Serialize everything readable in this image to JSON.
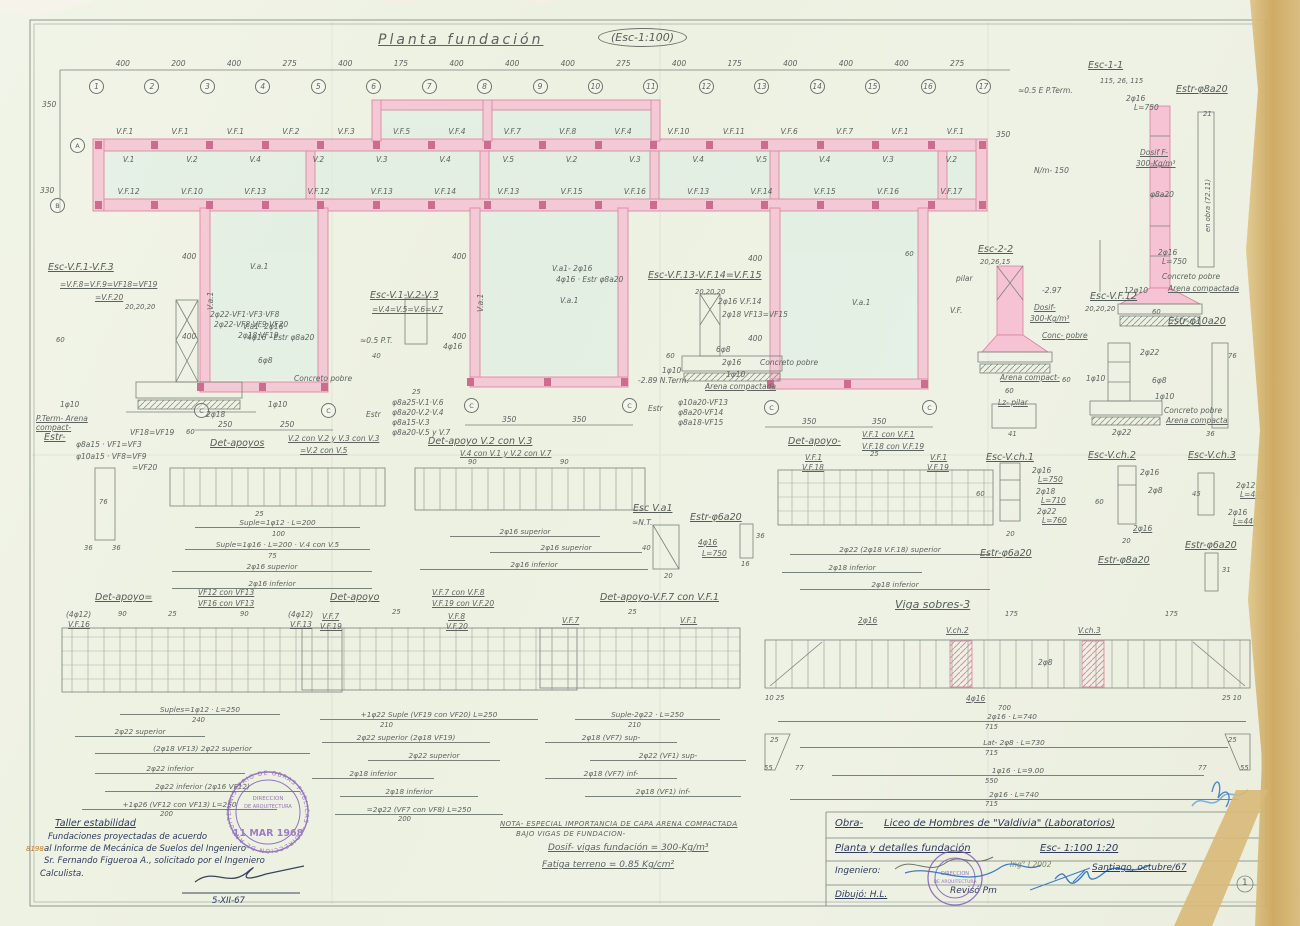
{
  "title": {
    "name": "Planta fundación",
    "scale": "(Esc-1:100)"
  },
  "plan": {
    "dims_top": [
      "400",
      "200",
      "400",
      "275",
      "400",
      "175",
      "400",
      "400",
      "400",
      "275",
      "400",
      "175",
      "400",
      "400",
      "400",
      "275"
    ],
    "bubbles": [
      "1",
      "2",
      "3",
      "4",
      "5",
      "6",
      "7",
      "8",
      "9",
      "10",
      "11",
      "12",
      "13",
      "14",
      "15",
      "16",
      "17"
    ],
    "row_a": "A",
    "row_b": "B",
    "row_c": "C",
    "dim_350": "350",
    "dim_330": "330",
    "dim_400": "400",
    "dim_60": "60",
    "top_beams": [
      "V.F.1",
      "V.F.1",
      "V.F.1",
      "V.F.2",
      "V.F.3",
      "V.F.5",
      "V.F.4",
      "V.F.7",
      "V.F.8",
      "V.F.4",
      "V.F.10",
      "V.F.11",
      "V.F.6",
      "V.F.7",
      "V.F.1",
      "V.F.1"
    ],
    "inner_beams": [
      "V.1",
      "V.2",
      "V.4",
      "V.2",
      "V.3",
      "V.4",
      "V.5",
      "V.2",
      "V.3",
      "V.4",
      "V.5",
      "V.4",
      "V.3",
      "V.2"
    ],
    "bottom_beams": [
      "V.F.12",
      "V.F.10",
      "V.F.13",
      "V.F.12",
      "V.F.13",
      "V.F.14",
      "V.F.13",
      "V.F.15",
      "V.F.16",
      "V.F.13",
      "V.F.14",
      "V.F.15",
      "V.F.16",
      "V.F.17"
    ],
    "wing1_dims": [
      "250",
      "250"
    ],
    "wing2_dims": [
      "350",
      "350"
    ],
    "wing3_dims": [
      "350",
      "350"
    ],
    "wall_label": "V.a.1",
    "wnote1": "V.a1- 2φ16",
    "wnote2": "4φ16 · Estr φ8a20"
  },
  "esc11": {
    "title": "Esc-1-1",
    "dims": "115, 26, 115",
    "estr": "Estr-φ8a20",
    "pterm": "≈0.5 E P.Term.",
    "bars_top": "2φ16",
    "bars_top_l": "L=750",
    "dosif1": "Dosif F-",
    "dosif2": "300-Kg/m³",
    "stirrup": "φ8a20",
    "bars_bot": "2φ16",
    "bars_bot_l": "L=750",
    "conc": "Concreto pobre",
    "arena": "Arena compactada",
    "b12": "12φ10",
    "w60": "60",
    "nm": "N/m- 150",
    "d350": "350",
    "bar21": "21",
    "obra": "en obra (72.11)"
  },
  "s1": {
    "t1": "Esc-V.F.1-V.F.3",
    "t2": "=V.F.8=V.F.9=VF18=VF19",
    "t3": "=V.F.20",
    "d20": "20,20,20",
    "l1": "2φ22-VF1·VF3·VF8",
    "l2": "2φ22-VF8·VF9·VF20",
    "l3": "2φ18 VF19",
    "l4": "6φ8",
    "d60": "60",
    "conc": "Concreto pobre",
    "f10a": "1φ10",
    "f10b": "1φ10",
    "f18": "2φ18",
    "arena": "P.Term- Arena compact-",
    "dbase": "60"
  },
  "s2": {
    "t1": "Esc-V.1-V.2-V.3",
    "t2": "=V.4=V.5=V.6=V.7",
    "pt": "≈0.5 P.T.",
    "d40": "40",
    "bars": "4φ16",
    "d25": "25",
    "estr": "Estr",
    "e1": "φ8a25-V.1·V.6",
    "e2": "φ8a20-V.2·V.4",
    "e3": "φ8a15-V.3",
    "e4": "φ8a20-V.5 y V.7"
  },
  "s3": {
    "t1": "Esc-V.F.13-V.F.14=V.F.15",
    "d20": "20,20,20",
    "l1": "2φ16 V.F.14",
    "l2": "2φ18 VF13=VF15",
    "l3": "6φ8",
    "d60": "60",
    "f10a": "1φ10",
    "f16": "2φ16",
    "f10b": "1φ10",
    "conc": "Concreto pobre",
    "arena": "Arena compactada",
    "nterm": "-2.89 N.Term.",
    "estr": "Estr",
    "e1": "φ10a20-VF13",
    "e2": "φ8a20-VF14",
    "e3": "φ8a18-VF15"
  },
  "s4": {
    "t1": "Esc-2-2",
    "dims": "20,26,15",
    "pilar": "pilar",
    "vf": "V.F.",
    "n297": "-2.97",
    "dosif1": "Dosif-",
    "dosif2": "300-Kg/m³",
    "conc": "Conc- pobre",
    "arena": "Arena compact-",
    "d60": "60",
    "lz": "Lz- pilar",
    "d41": "41"
  },
  "s5": {
    "t1": "Esc-V.F.12",
    "dims": "20,20,20",
    "estr": "Estr-φ10a20",
    "l1": "2φ22",
    "l2": "6φ8",
    "f10a": "1φ10",
    "f10b": "1φ10",
    "d60": "60",
    "conc": "Concreto pobre",
    "arena": "Arena compacta",
    "l3": "2φ22",
    "b76": "76",
    "b36": "36"
  },
  "estrtab": {
    "t": "Estr-",
    "l1": "VF18=VF19",
    "l2": "φ8a15 · VF1=VF3",
    "l3": "φ10a15 · VF8=VF9",
    "l4": "=VF20",
    "b76": "76",
    "b36a": "36",
    "b36b": "36"
  },
  "det1": {
    "t": "Det-apoyos",
    "b1": "V.2 con V.2 y V.3 con V.3",
    "b2": "=V.2 con V.5",
    "d25": "25",
    "s1": "Suple=1φ12 · L=200",
    "n100": "100",
    "s2": "Suple=1φ16 · L=200 · V.4 con V.5",
    "n75": "75",
    "s3": "2φ16 superior",
    "s4": "2φ16 inferior"
  },
  "det2": {
    "t": "Det-apoyo V.2 con V.3",
    "sub": "V.4 con V.1 y V.2 con V.7",
    "d90a": "90",
    "d90b": "90",
    "s1": "2φ16 superior",
    "s2": "2φ16 superior",
    "s3": "2φ16 inferior"
  },
  "det3": {
    "t": "Det-apoyo-",
    "b1": "V.F.1 con V.F.1",
    "b2": "V.F.18 con V.F.19",
    "lta": "V.F.1",
    "ltb": "V.F.18",
    "rta": "V.F.1",
    "rtb": "V.F.19",
    "d25": "25",
    "s1": "2φ22 (2φ18 V.F.18) superior",
    "s2": "2φ18 inferior",
    "s3": "2φ18 inferior"
  },
  "va1": {
    "t": "Esc V.a1",
    "nt": "≈N.T.",
    "d40": "40",
    "bars": "4φ16",
    "barsl": "L=750",
    "d20": "20",
    "estr": "Estr-φ6a20",
    "b36": "36",
    "b16": "16"
  },
  "vch1": {
    "t": "Esc-V.ch.1",
    "l1": "2φ16",
    "l1b": "L=750",
    "l2": "2φ18",
    "l2b": "L=710",
    "l3": "2φ22",
    "l3b": "L=760",
    "d60": "60",
    "d20": "20",
    "estr": "Estr-φ6a20"
  },
  "vch2": {
    "t": "Esc-V.ch.2",
    "l1": "2φ16",
    "l2": "2φ8",
    "l3": "2φ16",
    "d60": "60",
    "d20": "20",
    "estr": "Estr-φ8a20"
  },
  "vch3": {
    "t": "Esc-V.ch.3",
    "l1": "2φ12",
    "l1b": "L=440",
    "l2": "2φ16",
    "l2b": "L=440",
    "d45": "45",
    "estr": "Estr-φ6a20",
    "d31": "31"
  },
  "det4": {
    "t": "Det-apoyo=",
    "b1": "VF12 con VF13",
    "b2": "VF16 con VF13",
    "la": "(4φ12)",
    "lb": "V.F.16",
    "ra": "(4φ12)",
    "rb": "V.F.13",
    "d90a": "90",
    "d90b": "90",
    "d25": "25",
    "s1": "Suples=1φ12 · L=250",
    "n240": "240",
    "s2": "2φ22 superior",
    "s3": "(2φ18 VF13) 2φ22 superior",
    "s4": "2φ22 inferior",
    "s5": "2φ22 inferior (2φ16 VF12)",
    "s6": "+1φ26 (VF12 con VF13) L=250",
    "n200": "200"
  },
  "det5": {
    "t": "Det-apoyo",
    "b1": "V.F.7 con V.F.8",
    "b2": "V.F.19 con V.F.20",
    "lta": "V.F.7",
    "ltb": "V.F.19",
    "rta": "V.F.8",
    "rtb": "V.F.20",
    "d25": "25",
    "s1": "+1φ22 Suple (VF19 con VF20) L=250",
    "n210": "210",
    "s2": "2φ22 superior (2φ18 VF19)",
    "s3": "2φ22 superior",
    "s4": "2φ18 inferior",
    "s5": "2φ18 inferior",
    "s6": "=2φ22 (VF7 con VF8) L=250",
    "n200": "200"
  },
  "det6": {
    "t": "Det-apoyo-V.F.7 con V.F.1",
    "lt": "V.F.7",
    "rt": "V.F.1",
    "d25": "25",
    "s1": "Suple-2φ22 · L=250",
    "n210": "210",
    "s2": "2φ18 (VF7) sup-",
    "s3": "2φ22 (VF1) sup-",
    "s4": "2φ18 (VF7) inf-",
    "s5": "2φ18 (VF1) inf-"
  },
  "viga": {
    "t": "Viga sobres-3",
    "bars": "2φ16",
    "d175a": "175",
    "d175b": "175",
    "c1": "V.ch.2",
    "c2": "V.ch.3",
    "mid": "2φ8",
    "bot": "4φ16",
    "n700": "700",
    "ctl": "10 25",
    "ctr": "25 10",
    "s1": "2φ16 · L=740",
    "n715a": "715",
    "s2": "Lat- 2φ8 · L=730",
    "n715b": "715",
    "s3": "1φ16 · L=9.00",
    "n550": "550",
    "s4": "2φ16 · L=740",
    "n715c": "715",
    "e25a": "25",
    "e55a": "55",
    "e77a": "77",
    "e77b": "77",
    "e55b": "55",
    "e25b": "25"
  },
  "notes": {
    "l1": "NOTA- ESPECIAL IMPORTANCIA DE CAPA ARENA COMPACTADA",
    "l2": "BAJO VIGAS DE FUNDACION-",
    "l3": "Dosif- vigas fundación = 300-Kg/m³",
    "l4": "Fatiga terreno = 0.85 Kg/cm²"
  },
  "handnote": {
    "l1": "Taller estabilidad",
    "l2": "Fundaciones proyectadas de acuerdo",
    "l3": "al Informe de Mecánica de Suelos del Ingeniero",
    "l4": "Sr. Fernando Figueroa A., solicitado por el Ingeniero",
    "l5": "Calculista.",
    "date": "5-XII-67",
    "margin": "8198-"
  },
  "titleblock": {
    "obra_label": "Obra-",
    "obra": "Liceo de Hombres de \"Valdivia\" (Laboratorios)",
    "plano": "Planta y detalles fundación",
    "escalas": "Esc- 1:100   1:20",
    "ing": "Ingeniero:",
    "ing_note": "Ing° I 2002",
    "fecha": "Santiago, octubre/67",
    "dibujo": "Dibujó: H.L.",
    "reviso": "Revisó Pm",
    "page": "1"
  },
  "stamps": {
    "ring": "MINISTERIO DE OBRAS PUBLICAS — DIRECCION DE ARQUITECTURA",
    "date": "11 MAR 1968",
    "inner1": "DIRECCION",
    "inner2": "DE ARQUITECTURA"
  }
}
